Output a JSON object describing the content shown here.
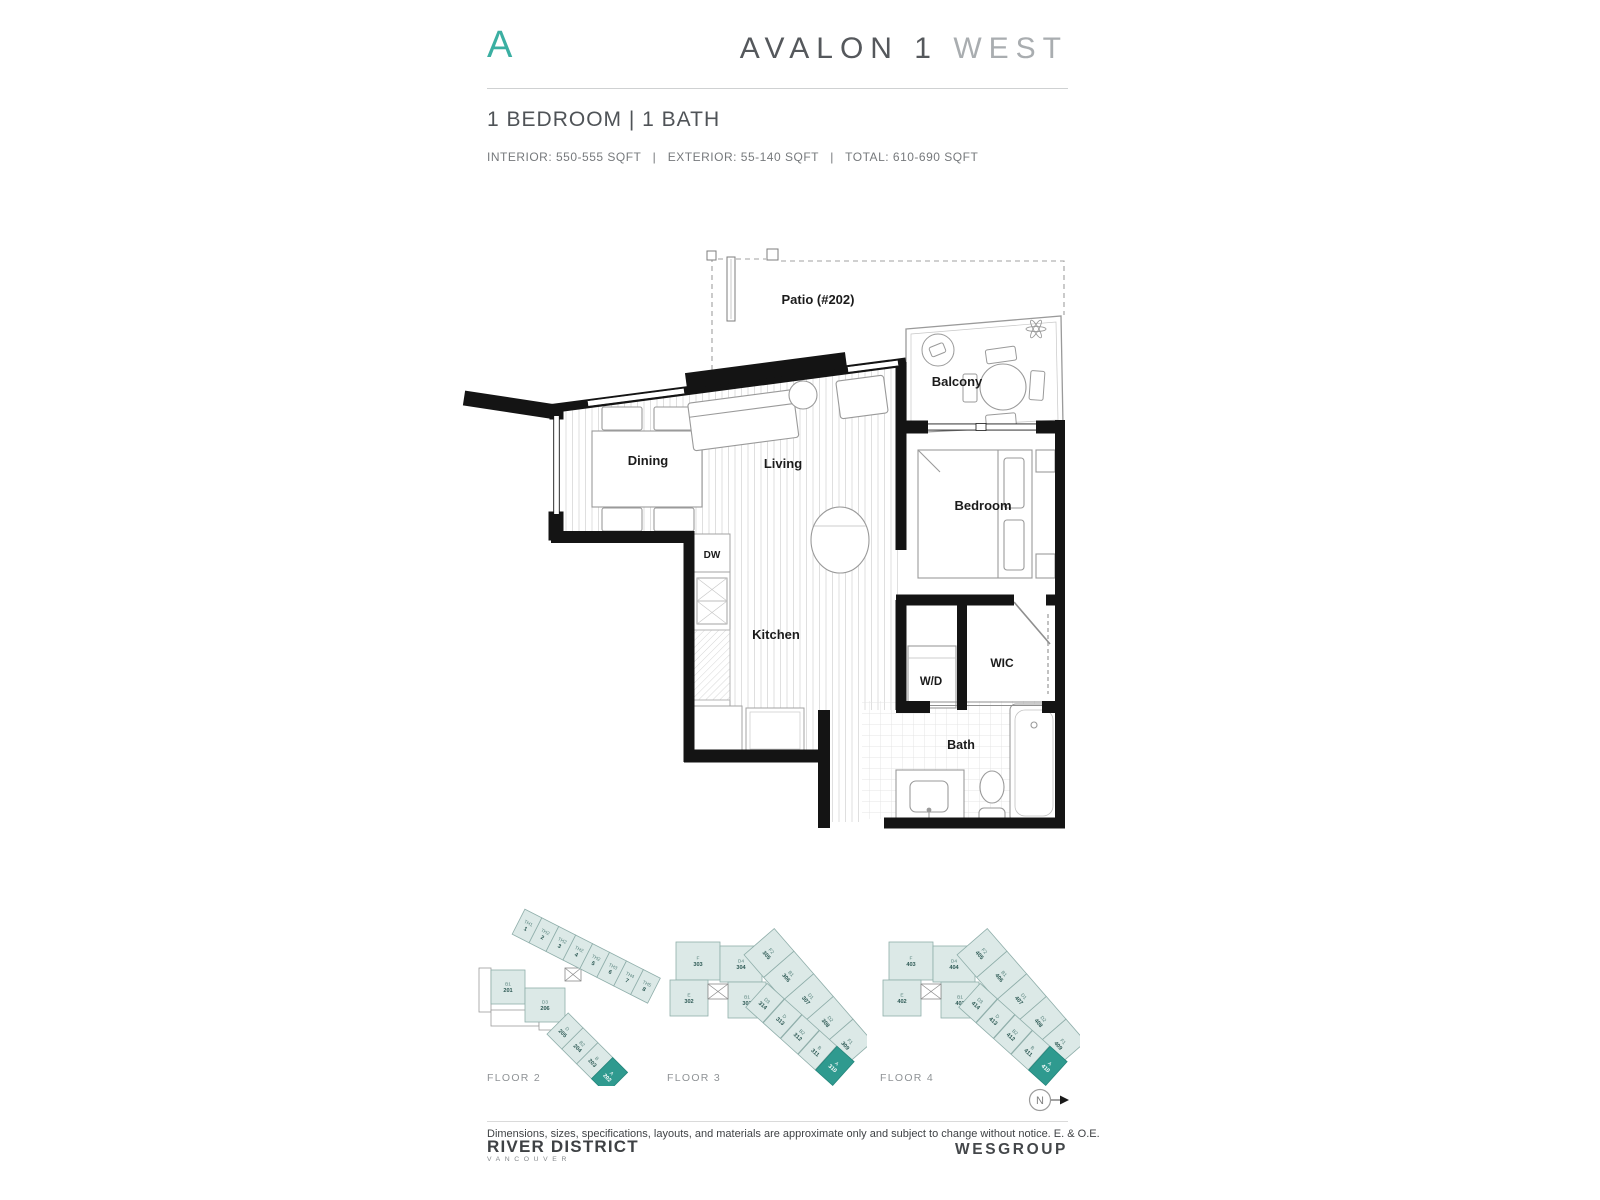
{
  "header": {
    "plan_letter": "A",
    "title_main": "AVALON 1",
    "title_accent": "WEST",
    "subtitle": "1 BEDROOM | 1 BATH",
    "specs": "INTERIOR: 550-555 SQFT   |   EXTERIOR: 55-140 SQFT   |   TOTAL: 610-690 SQFT"
  },
  "plan": {
    "labels": {
      "patio": "Patio (#202)",
      "balcony": "Balcony",
      "dining": "Dining",
      "living": "Living",
      "bedroom": "Bedroom",
      "kitchen": "Kitchen",
      "dw": "DW",
      "wd": "W/D",
      "wic": "WIC",
      "bath": "Bath"
    }
  },
  "keyplans": {
    "floors": [
      {
        "label": "FLOOR 2",
        "cluster": [
          {
            "t": "B1",
            "n": "201"
          },
          {
            "t": "D3",
            "n": "206"
          }
        ],
        "row1": [
          {
            "t": "TH1",
            "n": "1"
          },
          {
            "t": "TH2",
            "n": "2"
          },
          {
            "t": "TH2",
            "n": "3"
          },
          {
            "t": "TH2",
            "n": "4"
          },
          {
            "t": "TH2",
            "n": "5"
          },
          {
            "t": "TH3",
            "n": "6"
          },
          {
            "t": "TH4",
            "n": "7"
          },
          {
            "t": "TH5",
            "n": "8"
          }
        ],
        "row2": [
          {
            "t": "D",
            "n": "205"
          },
          {
            "t": "B2",
            "n": "204"
          },
          {
            "t": "B",
            "n": "203"
          },
          {
            "t": "A",
            "n": "202",
            "hl": true
          }
        ]
      },
      {
        "label": "FLOOR 3",
        "cluster": [
          {
            "t": "F",
            "n": "303"
          },
          {
            "t": "D4",
            "n": "304"
          },
          {
            "t": "E",
            "n": "302"
          },
          {
            "t": "B1",
            "n": "301"
          }
        ],
        "row1": [
          {
            "t": "F2",
            "n": "305"
          },
          {
            "t": "B1",
            "n": "306"
          },
          {
            "t": "D1",
            "n": "307"
          },
          {
            "t": "D2",
            "n": "308"
          },
          {
            "t": "F1",
            "n": "309"
          }
        ],
        "row2": [
          {
            "t": "D3",
            "n": "314"
          },
          {
            "t": "D",
            "n": "313"
          },
          {
            "t": "B2",
            "n": "312"
          },
          {
            "t": "B",
            "n": "311"
          },
          {
            "t": "A",
            "n": "310",
            "hl": true
          }
        ]
      },
      {
        "label": "FLOOR 4",
        "cluster": [
          {
            "t": "F",
            "n": "403"
          },
          {
            "t": "D4",
            "n": "404"
          },
          {
            "t": "E",
            "n": "402"
          },
          {
            "t": "B1",
            "n": "401"
          }
        ],
        "row1": [
          {
            "t": "F2",
            "n": "405"
          },
          {
            "t": "B1",
            "n": "406"
          },
          {
            "t": "D1",
            "n": "407"
          },
          {
            "t": "D2",
            "n": "408"
          },
          {
            "t": "F1",
            "n": "409"
          }
        ],
        "row2": [
          {
            "t": "D3",
            "n": "414"
          },
          {
            "t": "D",
            "n": "413"
          },
          {
            "t": "B2",
            "n": "412"
          },
          {
            "t": "B",
            "n": "411"
          },
          {
            "t": "A",
            "n": "410",
            "hl": true
          }
        ]
      }
    ]
  },
  "compass": {
    "label": "N"
  },
  "footer": {
    "disclaimer": "Dimensions, sizes, specifications, layouts, and materials are approximate only and subject to change without notice. E. & O.E.",
    "brand": "RIVER DISTRICT",
    "brand_sub": "VANCOUVER",
    "developer": "WESGROUP"
  },
  "colors": {
    "accent": "#3BAFA2",
    "keyplan_fill": "#DCE9E7",
    "keyplan_stroke": "#8FAEAA",
    "keyplan_highlight": "#2F9A8F"
  }
}
